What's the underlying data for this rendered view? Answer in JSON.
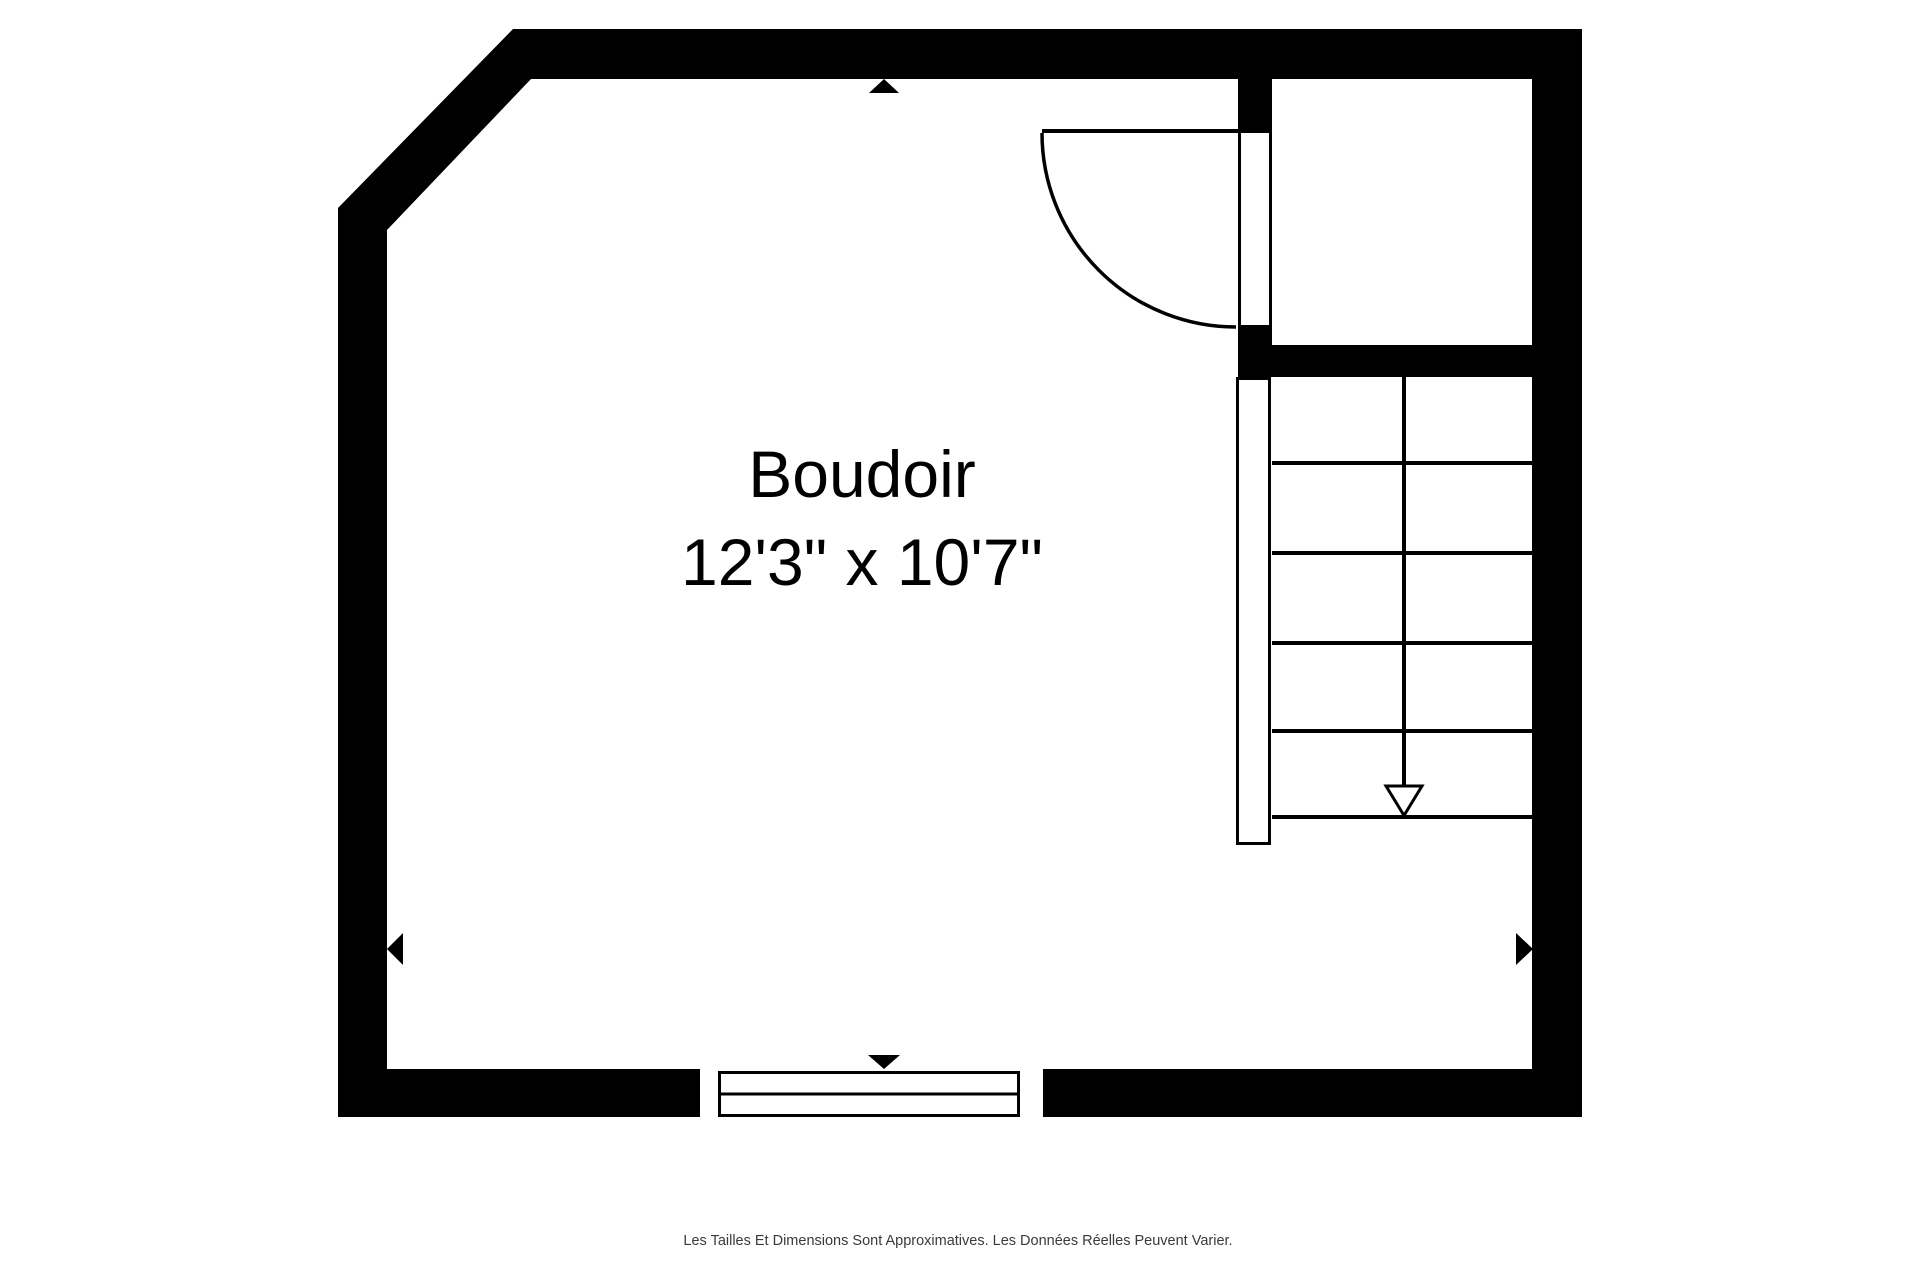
{
  "page": {
    "background": "#ffffff",
    "disclaimer": "Les Tailles Et Dimensions Sont Approximatives. Les Données Réelles Peuvent Varier."
  },
  "room": {
    "name": "Boudoir",
    "dimensions": "12'3\" x 10'7\""
  },
  "stairs": {
    "tread_count": 5,
    "arrow_direction": "down"
  },
  "door": {
    "type": "single-swing",
    "swing": "quarter-circle-into-room"
  },
  "markers": {
    "top": "triangle-up",
    "bottom": "triangle-down",
    "left": "triangle-left",
    "right": "triangle-right"
  },
  "colors": {
    "wall": "#000000",
    "line": "#000000",
    "floor": "#ffffff",
    "label_text": "#000000",
    "disclaimer_text": "#3a3a3a"
  }
}
